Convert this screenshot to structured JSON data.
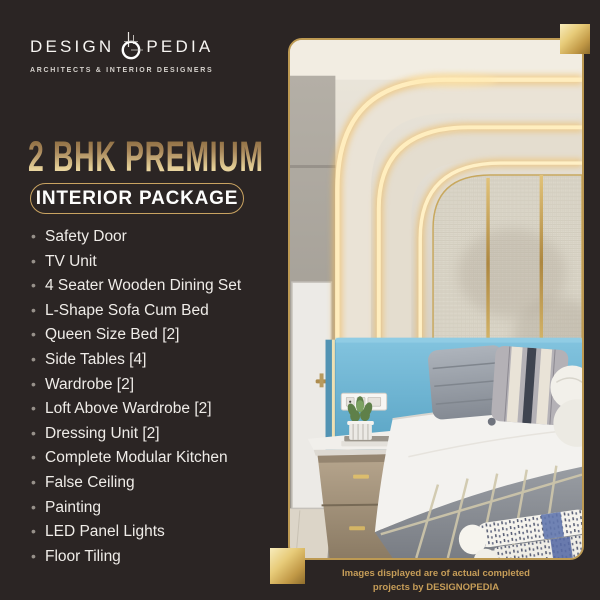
{
  "background": "#2b2524",
  "brand": {
    "name_left": "DESIGN",
    "name_right": "PEDIA",
    "tagline": "ARCHITECTS & INTERIOR DESIGNERS",
    "o_icon": "drafting-compass-o-icon"
  },
  "headline": {
    "title": "2 BHK PREMIUM",
    "badge": "INTERIOR PACKAGE"
  },
  "package": {
    "bullet": "•",
    "items": [
      "Safety Door",
      "TV Unit",
      "4 Seater Wooden Dining Set",
      "L-Shape Sofa Cum Bed",
      "Queen Size Bed [2]",
      "Side Tables [4]",
      "Wardrobe [2]",
      "Loft Above Wardrobe [2]",
      "Dressing Unit [2]",
      "Complete Modular Kitchen",
      "False Ceiling",
      "Painting",
      "LED Panel Lights",
      "Floor Tiling"
    ]
  },
  "photo": {
    "caption_line1": "Images displayed are of actual completed",
    "caption_line2": "projects by DESIGNOPEDIA"
  },
  "colors": {
    "gold_accent": "#c9a361",
    "gold_light": "#f3dfa8",
    "gold_dark": "#8a6a3a",
    "headline_gradient_top": "#85653a",
    "headline_gradient_bottom": "#f7ecc2",
    "list_text": "#efece8",
    "caption_text": "#c69d58",
    "headboard_blue": "#72b8d6",
    "logo_text": "#f7f5f2"
  }
}
